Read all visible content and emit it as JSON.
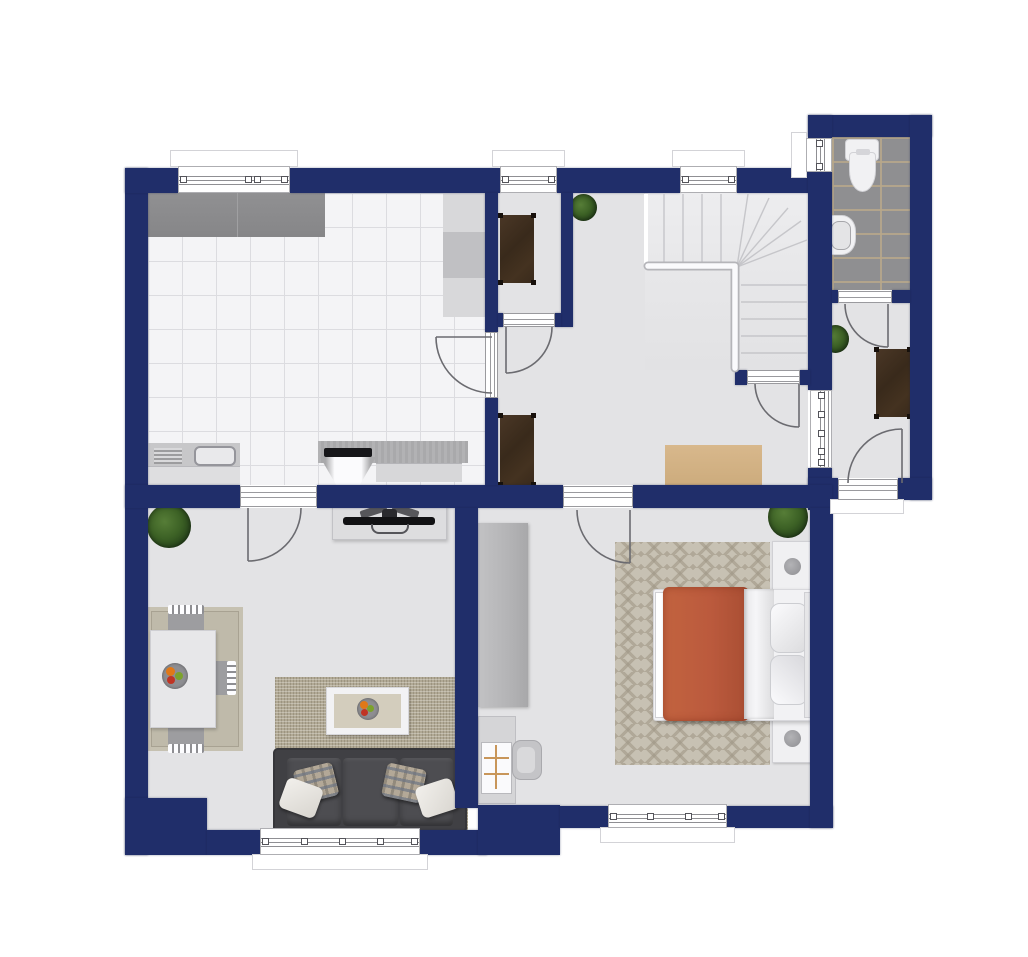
{
  "scene": {
    "type": "architectural-floor-plan",
    "view": "top-down",
    "background_color": "#ffffff",
    "wall_color": "#202e6a",
    "floor_color": "#e3e3e5",
    "text_labels": []
  },
  "palette": {
    "wall_navy": "#202e6a",
    "kitchen_tile": "#f4f4f6",
    "bath_tile_gray": "#8f8f91",
    "tile_grout_tan": "#b8a88a",
    "counter_dark_gray": "#8c8c8e",
    "wood_dark_brown": "#3f2e1f",
    "bed_duvet_terracotta": "#bb5a3d",
    "sofa_charcoal": "#404044",
    "rug_beige": "#bfbaaa",
    "rug_chevron_beige": "#c7c1b3",
    "hall_runner_tan": "#d2b083",
    "plant_green": "#3c6125",
    "fixture_white": "#f1f1f3"
  },
  "rooms": [
    {
      "id": "kitchen",
      "floor": "white-tile-grid",
      "furniture": [
        "counter-top-dark",
        "tall-cabinet-column",
        "sink-with-drainboard",
        "stove-with-extractor-hood",
        "granite-worktop"
      ],
      "windows": 1,
      "doors": [
        "door-to-hallway"
      ]
    },
    {
      "id": "pantry",
      "floor": "gray",
      "furniture": [
        "wooden-side-table"
      ],
      "windows": 1,
      "doors": [
        "door-to-hallway"
      ]
    },
    {
      "id": "hallway",
      "floor": "gray",
      "furniture": [
        "l-shaped-staircase",
        "wooden-side-table",
        "runner-rug",
        "potted-plant"
      ],
      "windows": 1,
      "doors": [
        "door-from-kitchen",
        "door-from-pantry",
        "door-to-bedroom",
        "door-at-stair-foot",
        "cased-opening-to-vestibule"
      ]
    },
    {
      "id": "bathroom",
      "floor": "gray-brick-tile",
      "furniture": [
        "toilet",
        "wash-basin"
      ],
      "windows": 1,
      "doors": [
        "door-to-vestibule"
      ]
    },
    {
      "id": "vestibule",
      "floor": "gray",
      "furniture": [
        "wooden-desk",
        "potted-plant"
      ],
      "windows": 0,
      "doors": [
        "entrance-door",
        "door-from-bathroom",
        "cased-opening-to-hallway"
      ]
    },
    {
      "id": "living-room",
      "floor": "gray",
      "furniture": [
        "dining-table",
        "dining-chair-top",
        "dining-chair-bottom",
        "dining-chair-right",
        "fruit-bowl-on-table",
        "dining-rug",
        "tv-sideboard",
        "television-top-view",
        "sofa-three-seat",
        "plaid-pillow-left",
        "plaid-pillow-right",
        "white-pillow-left",
        "white-pillow-right",
        "coffee-table",
        "fruit-bowl-on-coffee-table",
        "textured-area-rug",
        "potted-plant"
      ],
      "windows": 1,
      "doors": [
        "door-from-kitchen"
      ]
    },
    {
      "id": "bedroom",
      "floor": "gray",
      "furniture": [
        "double-bed",
        "terracotta-duvet",
        "folded-white-sheet",
        "pillow-upper",
        "pillow-lower",
        "nightstand-upper-with-lamp",
        "nightstand-lower-with-lamp",
        "wardrobe",
        "desk-with-shelf",
        "desk-chair",
        "chevron-rug",
        "potted-plant"
      ],
      "windows": 1,
      "doors": [
        "door-from-hallway"
      ]
    }
  ],
  "counts": {
    "windows_total": 6,
    "interior_cased_openings": 1,
    "hinged_doors": 7,
    "staircases": 1,
    "potted_plants": 4
  }
}
